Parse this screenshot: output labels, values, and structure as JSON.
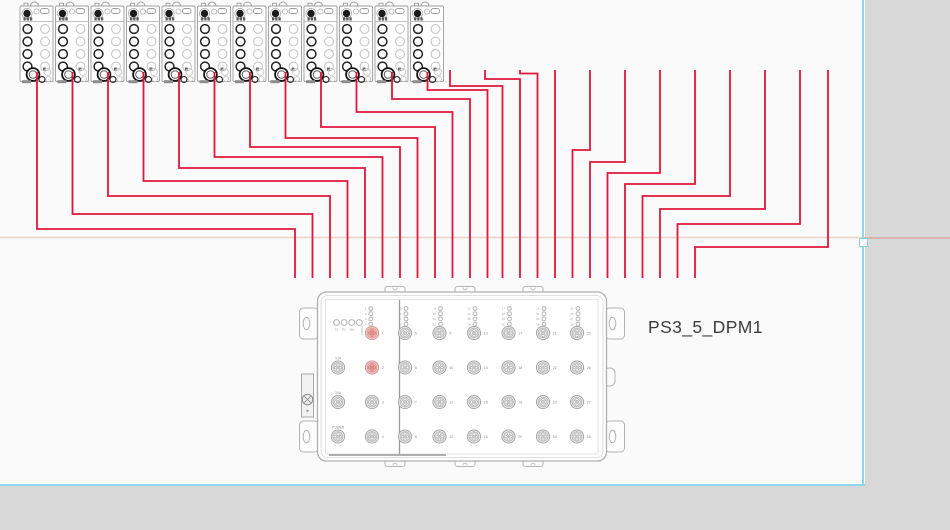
{
  "canvas": {
    "background": "#fafafa",
    "outside_color": "#d8d8d8",
    "page_boundary_color": "#8dd6ec",
    "guide_line_color": "#e4a79d",
    "guide_line_y": 237.5,
    "page_boundary": {
      "right_x": 863,
      "bottom_y": 484
    },
    "selection_handle": {
      "x": 863,
      "y": 241
    }
  },
  "device_label": {
    "text": "PS3_5_DPM1"
  },
  "modules": {
    "count": 12,
    "top": 6,
    "width": 33,
    "height": 75.5,
    "lefts": [
      20,
      55.5,
      91,
      126.5,
      162,
      197.5,
      233,
      268.5,
      304,
      339.5,
      375,
      410.5
    ]
  },
  "wires": {
    "color": "#e0173a",
    "stroke_width": 1.8,
    "polylines": [
      [
        [
          37,
          72
        ],
        [
          37,
          229
        ],
        [
          295,
          229
        ],
        [
          295,
          278
        ]
      ],
      [
        [
          72.5,
          72
        ],
        [
          72.5,
          214
        ],
        [
          312.5,
          214
        ],
        [
          312.5,
          278
        ]
      ],
      [
        [
          108,
          72
        ],
        [
          108,
          196
        ],
        [
          330,
          196
        ],
        [
          330,
          278
        ]
      ],
      [
        [
          143.5,
          72
        ],
        [
          143.5,
          181
        ],
        [
          347.5,
          181
        ],
        [
          347.5,
          278
        ]
      ],
      [
        [
          179,
          72
        ],
        [
          179,
          168
        ],
        [
          365,
          168
        ],
        [
          365,
          278
        ]
      ],
      [
        [
          214.5,
          72
        ],
        [
          214.5,
          157
        ],
        [
          382.5,
          157
        ],
        [
          382.5,
          278
        ]
      ],
      [
        [
          250,
          72
        ],
        [
          250,
          147
        ],
        [
          400,
          147
        ],
        [
          400,
          278
        ]
      ],
      [
        [
          285.5,
          72
        ],
        [
          285.5,
          138
        ],
        [
          417.5,
          138
        ],
        [
          417.5,
          278
        ]
      ],
      [
        [
          321,
          72
        ],
        [
          321,
          127
        ],
        [
          435,
          127
        ],
        [
          435,
          278
        ]
      ],
      [
        [
          356.5,
          72
        ],
        [
          356.5,
          112
        ],
        [
          452.5,
          112
        ],
        [
          452.5,
          278
        ]
      ],
      [
        [
          392,
          72
        ],
        [
          392,
          99
        ],
        [
          470,
          99
        ],
        [
          470,
          278
        ]
      ],
      [
        [
          427.5,
          72
        ],
        [
          427.5,
          90
        ],
        [
          487.5,
          90
        ],
        [
          487.5,
          278
        ]
      ],
      [
        [
          450,
          70
        ],
        [
          450,
          86
        ],
        [
          502.5,
          86
        ],
        [
          502.5,
          278
        ]
      ],
      [
        [
          485,
          70
        ],
        [
          485,
          79
        ],
        [
          520,
          79
        ],
        [
          520,
          278
        ]
      ],
      [
        [
          520,
          70
        ],
        [
          520,
          73.5
        ],
        [
          537.5,
          73.5
        ],
        [
          537.5,
          278
        ]
      ],
      [
        [
          555,
          70
        ],
        [
          555,
          278
        ]
      ],
      [
        [
          590,
          70
        ],
        [
          590,
          150
        ],
        [
          572.5,
          150
        ],
        [
          572.5,
          278
        ]
      ],
      [
        [
          625,
          70
        ],
        [
          625,
          162
        ],
        [
          590,
          162
        ],
        [
          590,
          278
        ]
      ],
      [
        [
          660,
          70
        ],
        [
          660,
          173
        ],
        [
          607.5,
          173
        ],
        [
          607.5,
          278
        ]
      ],
      [
        [
          695,
          70
        ],
        [
          695,
          184
        ],
        [
          625,
          184
        ],
        [
          625,
          278
        ]
      ],
      [
        [
          730,
          70
        ],
        [
          730,
          196
        ],
        [
          642.5,
          196
        ],
        [
          642.5,
          278
        ]
      ],
      [
        [
          765,
          70
        ],
        [
          765,
          209
        ],
        [
          660,
          209
        ],
        [
          660,
          278
        ]
      ],
      [
        [
          800,
          70
        ],
        [
          800,
          224
        ],
        [
          677.5,
          224
        ],
        [
          677.5,
          278
        ]
      ],
      [
        [
          828,
          70
        ],
        [
          828,
          247
        ],
        [
          695,
          247
        ],
        [
          695,
          278
        ]
      ]
    ]
  },
  "device": {
    "body": {
      "x": 317.5,
      "y": 292,
      "w": 289,
      "h": 169
    },
    "divider_x": 399.5,
    "status_leds": {
      "labels": [
        "P1",
        "P2",
        "SM"
      ],
      "fault_label": "FAULT",
      "x0": 336.5,
      "dx": 7.6,
      "y": 322.5
    },
    "left_led_stack": {
      "numbers": [
        "1",
        "2",
        "3",
        "4"
      ],
      "num_x": 366.5,
      "circ_x": 370.8,
      "y0": 308.5,
      "dy": 5.2
    },
    "aux_ports": [
      {
        "label": "X24",
        "x": 338,
        "y": 367.5
      },
      {
        "label": "X0A",
        "x": 338,
        "y": 402
      },
      {
        "label": "POWER",
        "x": 338,
        "y": 436.5
      }
    ],
    "numbered_left_col": {
      "x": 372,
      "rows_y": [
        333,
        367.5,
        402,
        436.5
      ],
      "numbers": [
        "1",
        "2",
        "3",
        "4"
      ],
      "red_ports": [
        "1",
        "2"
      ]
    },
    "right_grid": {
      "cols_x": [
        405,
        439.5,
        474,
        508.5,
        543,
        577
      ],
      "rows_y": [
        333,
        367.5,
        402,
        436.5
      ],
      "numbers": [
        [
          "5",
          "6",
          "7",
          "8"
        ],
        [
          "9",
          "10",
          "11",
          "12"
        ],
        [
          "13",
          "14",
          "15",
          "16"
        ],
        [
          "17",
          "18",
          "19",
          "20"
        ],
        [
          "21",
          "22",
          "23",
          "24"
        ],
        [
          "25",
          "26",
          "27",
          "28"
        ]
      ]
    },
    "port_colors": {
      "red_fill": "#f5b9b6",
      "red_stroke": "#d09190",
      "gray_fill": "#ededed",
      "gray_stroke": "#a0a0a0"
    }
  }
}
